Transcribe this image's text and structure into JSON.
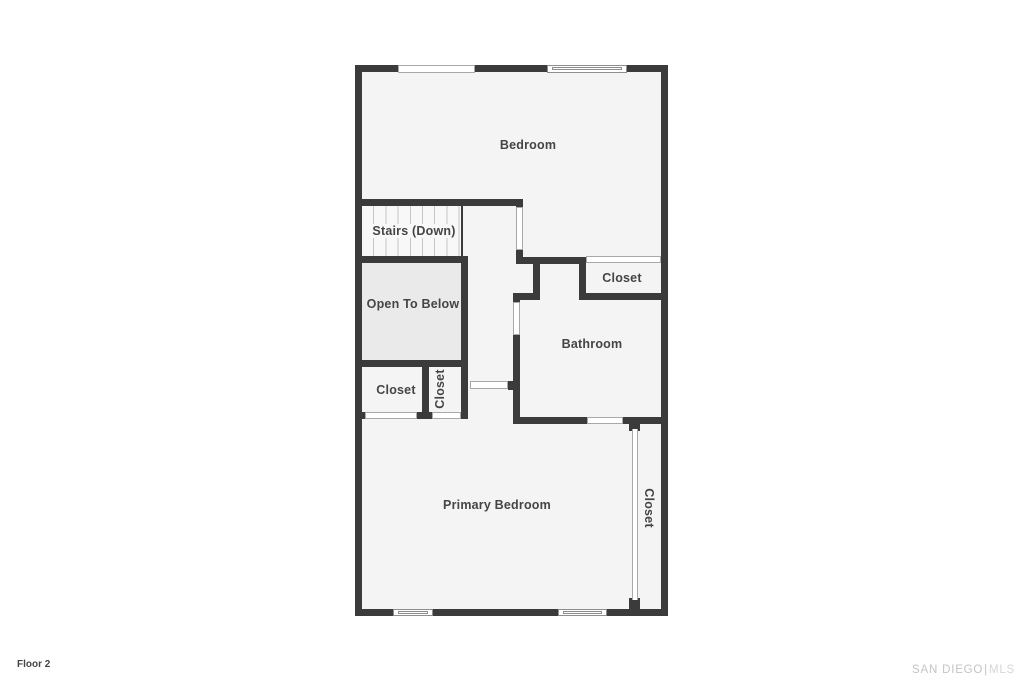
{
  "floor_label": "Floor 2",
  "watermark": {
    "brand": "SAN DIEGO",
    "divider": "|",
    "suffix": "MLS"
  },
  "colors": {
    "wall": "#3b3b3b",
    "room_fill": "#f4f4f4",
    "stairs_fill": "#f8f8f8",
    "open_fill": "#eaeaea",
    "label": "#454545",
    "opening_border": "#a8a8a8",
    "window_border": "#8e8e8e",
    "watermark": "#c4c4c4",
    "watermark_light": "#d6d6d6"
  },
  "rooms": {
    "bedroom": {
      "label": "Bedroom"
    },
    "stairs": {
      "label": "Stairs (Down)"
    },
    "open_to_below": {
      "label": "Open To Below"
    },
    "closet_top_right": {
      "label": "Closet"
    },
    "bathroom": {
      "label": "Bathroom"
    },
    "closet_left": {
      "label": "Closet"
    },
    "closet_middle": {
      "label": "Closet"
    },
    "primary_bedroom": {
      "label": "Primary Bedroom"
    },
    "closet_right": {
      "label": "Closet"
    }
  }
}
